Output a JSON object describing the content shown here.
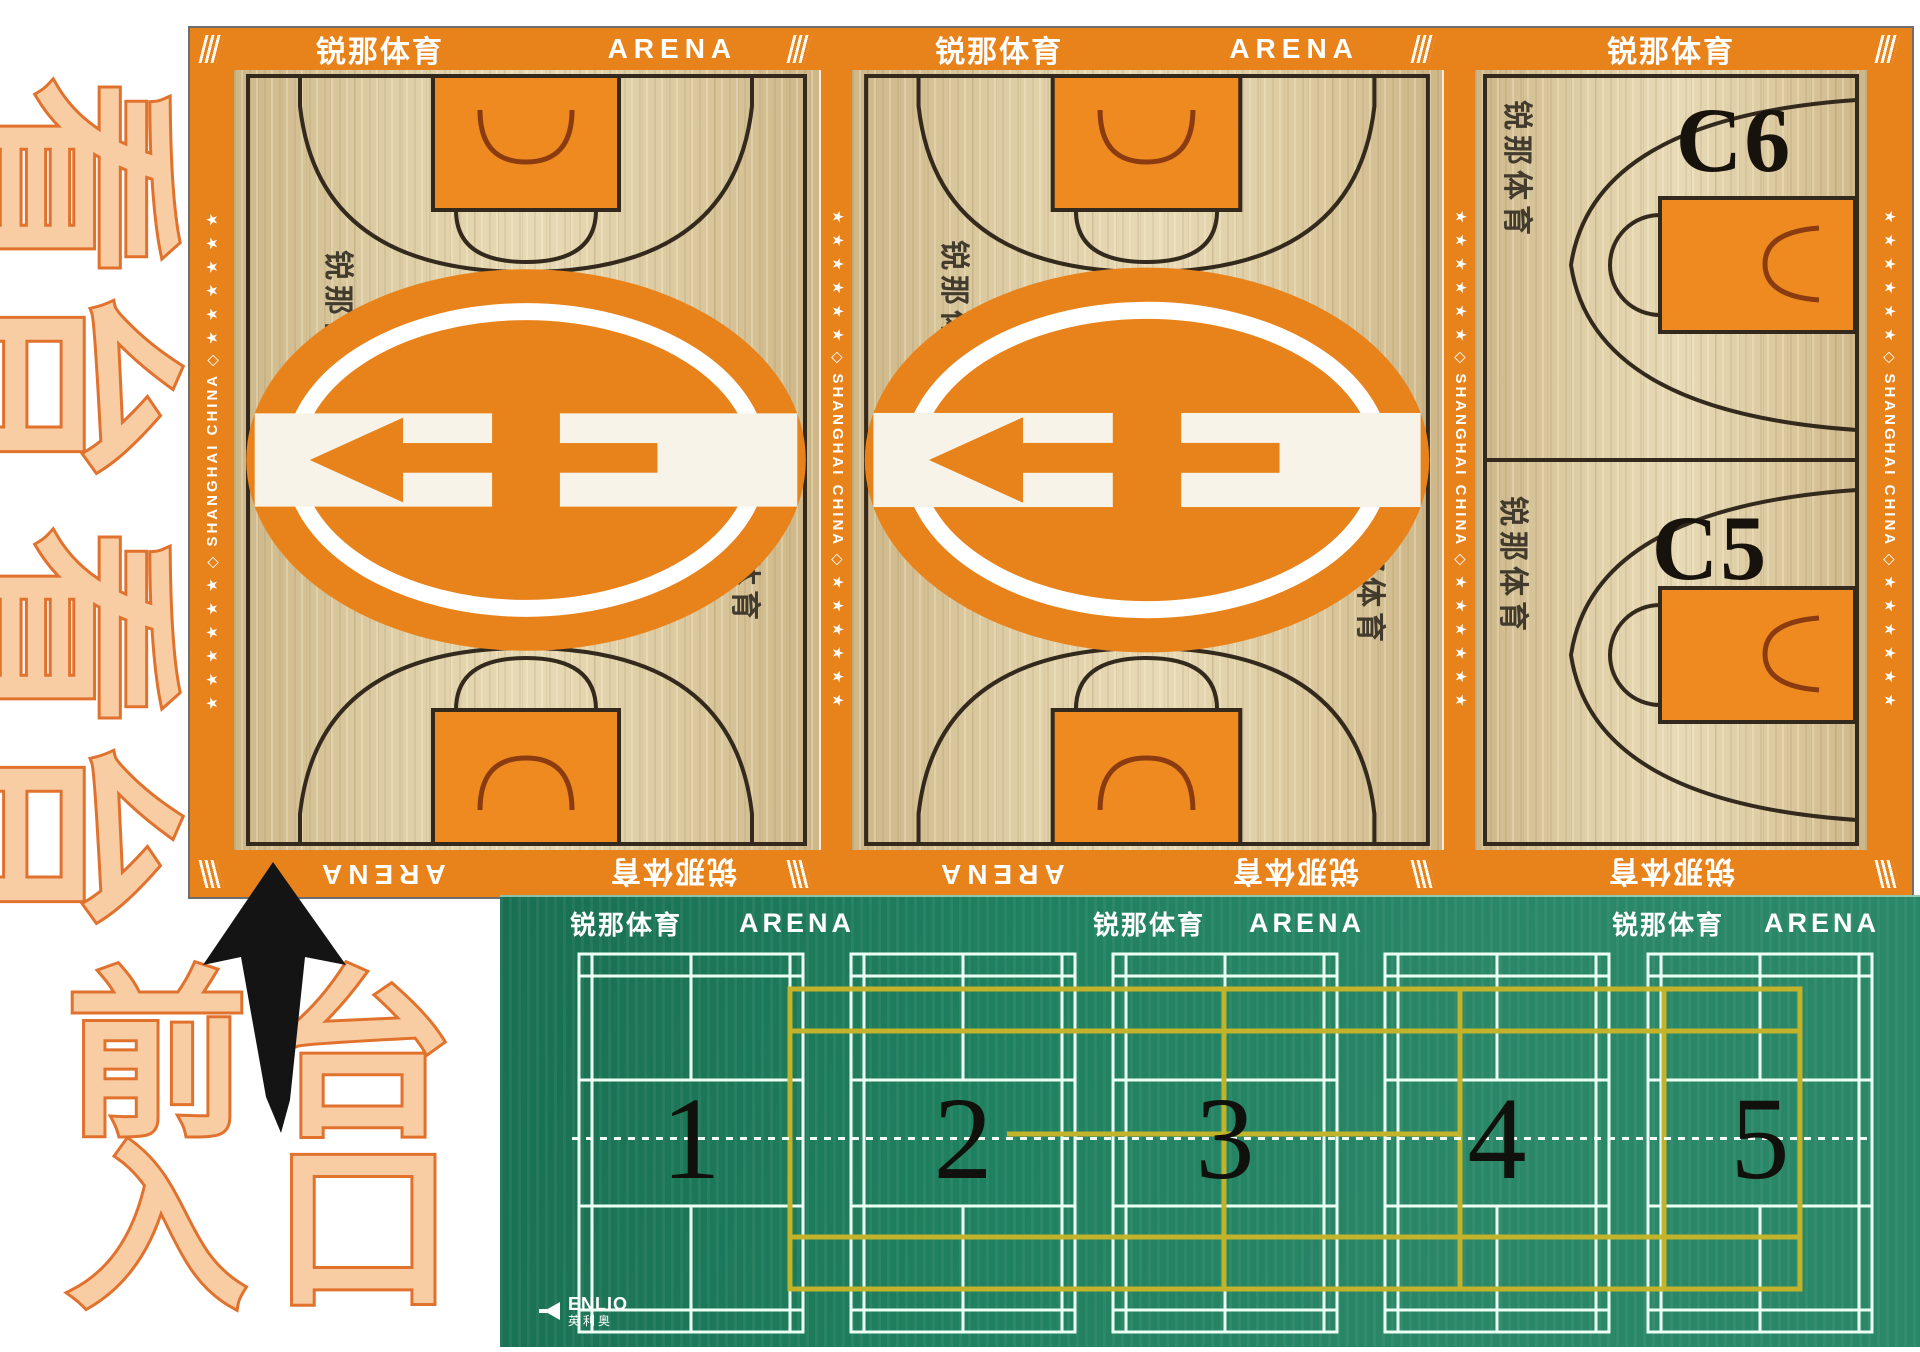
{
  "venue": {
    "brand_cn": "锐那体育",
    "brand_en": "ARENA",
    "side_text": "SHANGHAI CHINA"
  },
  "annotations": {
    "stands_upper": "看台",
    "stands_lower": "看台",
    "entrance_line1": "前台",
    "entrance_line2": "入口"
  },
  "basketball": {
    "strip_line": "★ ★ ★ ★ ★ ★  ◇  SHANGHAI CHINA  ◇  ★ ★ ★ ★ ★ ★",
    "top_border": [
      {
        "cn": "锐那体育",
        "en": "ARENA"
      },
      {
        "cn": "锐那体育",
        "en": "ARENA"
      },
      {
        "cn": "锐那体育"
      }
    ],
    "bottom_border": [
      {
        "en": "ARENA",
        "cn": "锐那体育"
      },
      {
        "en": "ARENA",
        "cn": "锐那体育"
      },
      {
        "cn": "锐那体育"
      }
    ],
    "courts": {
      "a": {
        "top_label": "A2",
        "bottom_label": "A1",
        "watermark": "锐那体育"
      },
      "b": {
        "top_label": "B4",
        "bottom_label": "B3",
        "watermark": "锐那体育"
      },
      "c": {
        "top_label": "C6",
        "bottom_label": "C5",
        "watermark": "锐那体育"
      }
    }
  },
  "badminton": {
    "headers": [
      {
        "cn": "锐那体育",
        "en": "ARENA"
      },
      {
        "cn": "锐那体育",
        "en": "ARENA"
      },
      {
        "cn": "锐那体育",
        "en": "ARENA"
      }
    ],
    "court_numbers": [
      "1",
      "2",
      "3",
      "4",
      "5"
    ],
    "brand_en": "ENLIO",
    "brand_cn": "英利奥"
  },
  "colors": {
    "border_orange": "#e8831c",
    "key_orange": "#ee8a20",
    "wood": "#d8c59a",
    "line_black": "#33291c",
    "hoop_brown": "#8a3c10",
    "green": "#1f8160",
    "court_line_white": "#ecfff5",
    "yellow": "#c3b32a",
    "peach_fill": "#f8cda4",
    "peach_stroke": "#e1722e"
  }
}
